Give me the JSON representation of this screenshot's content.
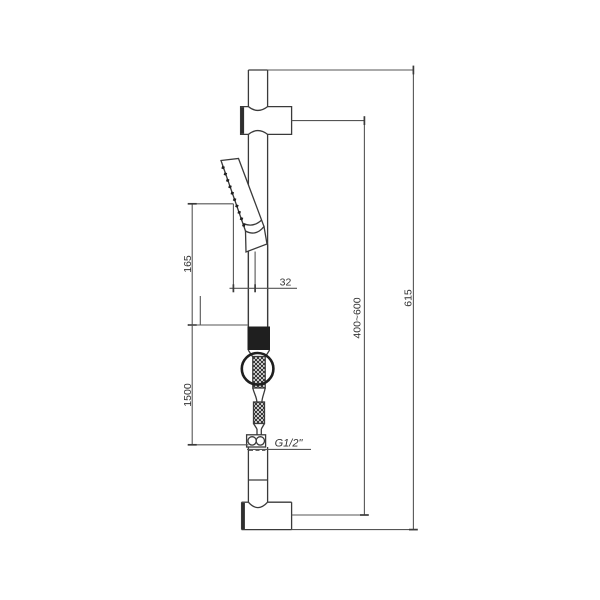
{
  "drawing": {
    "type": "technical-line-drawing",
    "subject": "shower slide rail with hand shower, hose and wall brackets",
    "background_color": "#ffffff",
    "colors": {
      "object_line": "#3a3a3a",
      "dimension_line": "#555555",
      "solid_fill": "#1f1f1f",
      "text": "#333333"
    },
    "dimensions": [
      {
        "id": "handset-length",
        "label": "165",
        "orientation": "vertical"
      },
      {
        "id": "handset-diameter",
        "label": "32",
        "orientation": "horizontal"
      },
      {
        "id": "hose-length",
        "label": "1500",
        "orientation": "vertical"
      },
      {
        "id": "thread-size",
        "label": "G1/2\"",
        "orientation": "horizontal"
      },
      {
        "id": "adjustable-height",
        "label": "400~600",
        "orientation": "vertical"
      },
      {
        "id": "overall-height",
        "label": "615",
        "orientation": "vertical"
      }
    ]
  }
}
